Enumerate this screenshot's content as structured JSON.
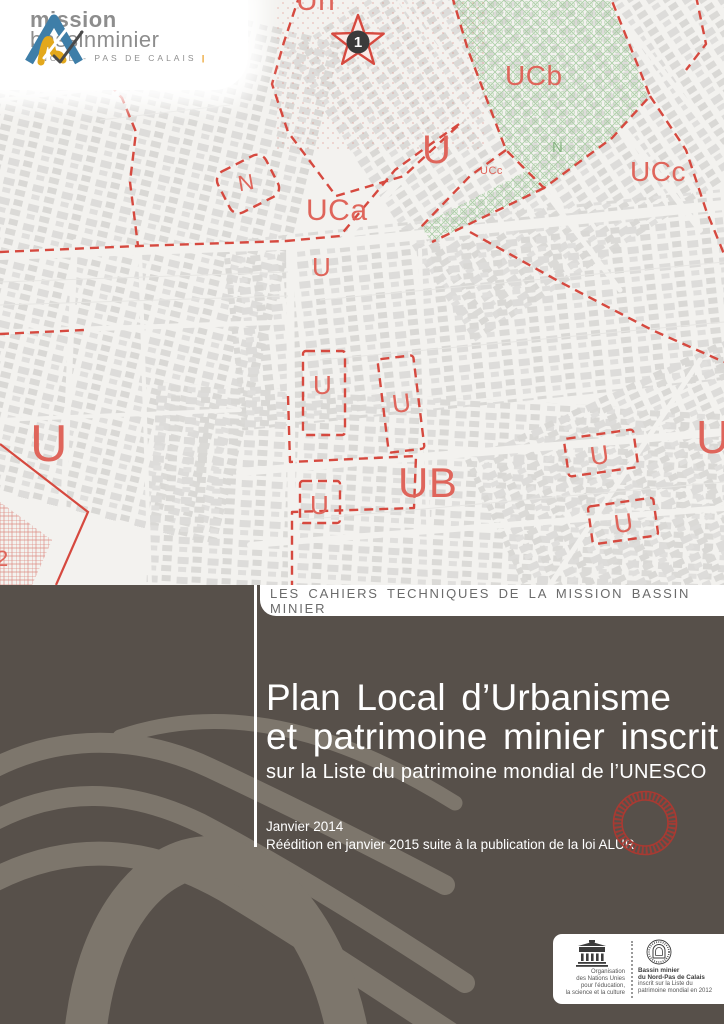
{
  "logo": {
    "name_top": "mission",
    "name_bottom": "bassinminier",
    "tagline": "NORD - PAS DE CALAIS",
    "pipe": "|"
  },
  "map": {
    "labels": {
      "uh": "Uh",
      "star": "1",
      "ucb": "UCb",
      "u_left": "U",
      "n_green": "N",
      "ucc_small": "UCc",
      "ucc": "UCc",
      "n_red": "N",
      "uca": "UCa",
      "u_a": "U",
      "u_big": "U",
      "u_b": "U",
      "u_c": "U",
      "u_d": "U",
      "ub": "UB",
      "u_e": "U",
      "u_f": "U",
      "u_right": "U",
      "two": "2"
    }
  },
  "band": {
    "series_title": "LES CAHIERS TECHNIQUES DE LA MISSION BASSIN MINIER"
  },
  "title": {
    "line1": "Plan Local d’Urbanisme",
    "line2": "et patrimoine minier inscrit",
    "line3": "sur la Liste du patrimoine mondial de l’UNESCO"
  },
  "edition": {
    "line1": "Janvier 2014",
    "line2": "Réédition en janvier 2015 suite à la publication de la loi ALUR"
  },
  "footer": {
    "unesco_lines": [
      "Organisation",
      "des Nations Unies",
      "pour l’éducation,",
      "la science et la culture"
    ],
    "wh_bold": [
      "Bassin minier",
      "du Nord-Pas de Calais"
    ],
    "wh_rest": [
      "inscrit sur la Liste du",
      "patrimoine mondial en 2012"
    ]
  },
  "colors": {
    "dark_background": "#57504a",
    "map_line_red": "#d6493f",
    "map_label_red": "#df655b",
    "map_green": "#9cc497",
    "seal_red": "#a93a32",
    "watermark_gray": "#7d766c",
    "logo_blue": "#3e7ea8",
    "logo_yellow": "#e3a81c",
    "logo_orange": "#e8960f"
  }
}
